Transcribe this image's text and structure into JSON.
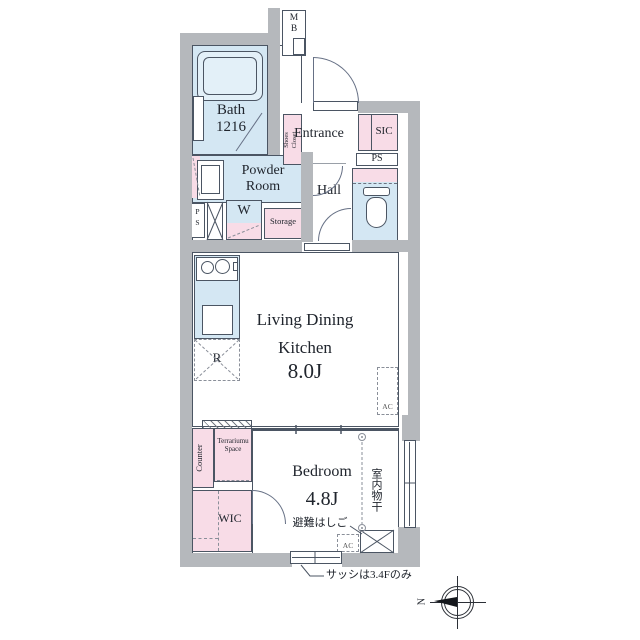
{
  "colors": {
    "wall": "#b5b8bc",
    "room_blue": "#d4e7f3",
    "closet_pink": "#f8dce7",
    "line": "#4b5563",
    "text": "#20252d"
  },
  "rooms": {
    "mb": {
      "line1": "M",
      "line2": "B"
    },
    "bath": {
      "name": "Bath",
      "size": "1216"
    },
    "shoes_closet": {
      "line1": "Shoes",
      "line2": "Closet"
    },
    "entrance": {
      "name": "Entrance"
    },
    "sic": {
      "name": "SIC"
    },
    "ps_right": {
      "name": "PS"
    },
    "powder": {
      "line1": "Powder",
      "line2": "Room"
    },
    "hall": {
      "name": "Hall"
    },
    "ps_left": {
      "line1": "P",
      "line2": "S"
    },
    "washer": {
      "name": "W"
    },
    "storage": {
      "name": "Storage"
    },
    "ldk": {
      "line1": "Living Dining",
      "line2": "Kitchen",
      "size": "8.0J"
    },
    "fridge": {
      "name": "R"
    },
    "ac_ldk": {
      "name": "AC"
    },
    "counter": {
      "name": "Counter"
    },
    "terrarium": {
      "line1": "Terrariumu",
      "line2": "Space"
    },
    "wic": {
      "name": "WIC"
    },
    "bedroom": {
      "name": "Bedroom",
      "size": "4.8J"
    },
    "drying_pole": {
      "name": "室内物干"
    },
    "escape_hatch": {
      "name": "避難はしご"
    },
    "ac_bedroom": {
      "name": "AC"
    }
  },
  "notes": {
    "sash": "サッシは3.4Fのみ"
  },
  "compass": {
    "north": "N"
  }
}
